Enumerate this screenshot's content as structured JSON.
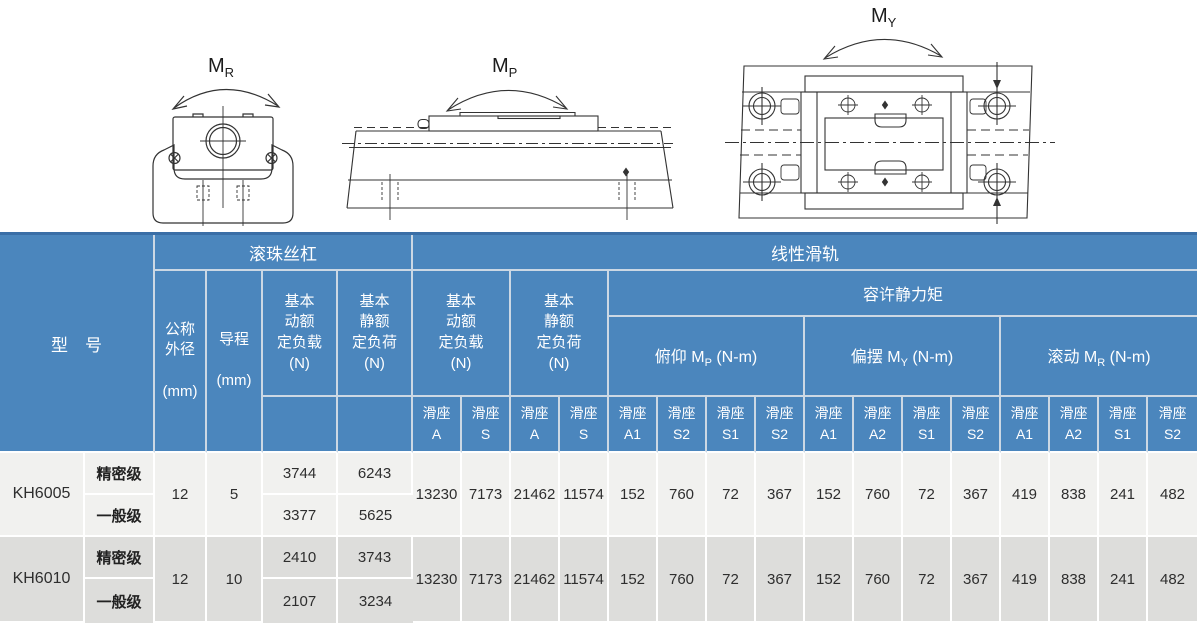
{
  "diagrams": {
    "mr": {
      "m": "M",
      "sub": "R"
    },
    "mp": {
      "m": "M",
      "sub": "P"
    },
    "my": {
      "m": "M",
      "sub": "Y"
    }
  },
  "table": {
    "colors": {
      "header_bg": "#4b86bd",
      "header_border": "#ccd8e4",
      "header_top_border": "#3a6ea6",
      "row_light": "#f1f1ef",
      "row_dark": "#dddddb",
      "body_text": "#2e2e2e"
    },
    "header": {
      "model": "型　号",
      "ball_screw": "滚珠丝杠",
      "linear_guide": "线性滑轨",
      "outer_dia": "公称\n外径\n\n(mm)",
      "lead": "导程\n\n(mm)",
      "bs_dynamic": "基本\n动额\n定负载\n(N)",
      "bs_static": "基本\n静额\n定负荷\n(N)",
      "lg_dynamic": "基本\n动额\n定负载\n(N)",
      "lg_static": "基本\n静额\n定负荷\n(N)",
      "moment": "容许静力矩",
      "pitch": {
        "pre": "俯仰 M",
        "sub": "P",
        "post": " (N-m)"
      },
      "yaw": {
        "pre": "偏摆 M",
        "sub": "Y",
        "post": " (N-m)"
      },
      "roll": {
        "pre": "滚动 M",
        "sub": "R",
        "post": " (N-m)"
      },
      "slider": "滑座",
      "slider_cols": [
        "A",
        "S",
        "A",
        "S",
        "A1",
        "S2",
        "S1",
        "S2",
        "A1",
        "A2",
        "S1",
        "S2",
        "A1",
        "A2",
        "S1",
        "S2"
      ]
    },
    "rows": [
      {
        "model": "KH6005",
        "grade_precision": "精密级",
        "grade_general": "一般级",
        "outer_dia": "12",
        "lead": "5",
        "bs_precision": [
          "3744",
          "6243"
        ],
        "bs_general": [
          "3377",
          "5625"
        ],
        "lg": [
          "13230",
          "7173",
          "21462",
          "11574",
          "152",
          "760",
          "72",
          "367",
          "152",
          "760",
          "72",
          "367",
          "419",
          "838",
          "241",
          "482"
        ]
      },
      {
        "model": "KH6010",
        "grade_precision": "精密级",
        "grade_general": "一般级",
        "outer_dia": "12",
        "lead": "10",
        "bs_precision": [
          "2410",
          "3743"
        ],
        "bs_general": [
          "2107",
          "3234"
        ],
        "lg": [
          "13230",
          "7173",
          "21462",
          "11574",
          "152",
          "760",
          "72",
          "367",
          "152",
          "760",
          "72",
          "367",
          "419",
          "838",
          "241",
          "482"
        ]
      }
    ]
  }
}
